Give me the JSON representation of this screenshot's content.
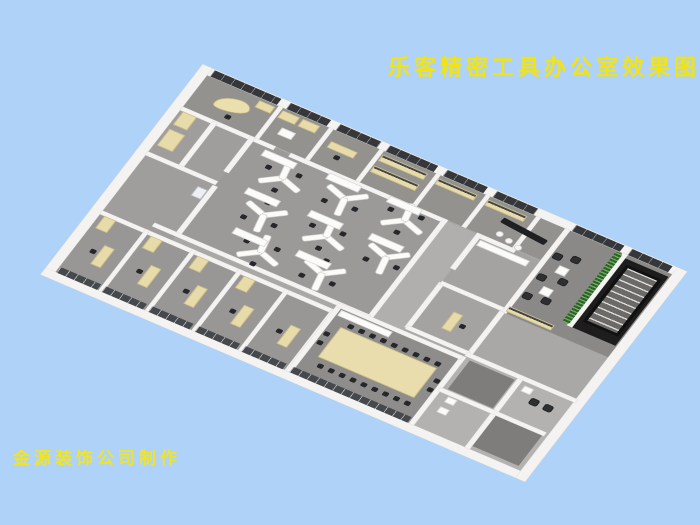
{
  "page": {
    "background": "#aed2f8"
  },
  "title": {
    "text": "乐客精密工具办公室效果图",
    "color": "#f2e318"
  },
  "credit": {
    "text": "金源装饰公司制作",
    "color": "#f0e42a"
  },
  "scene": {
    "description": "axonometric 3D rendering of an office floor plan",
    "wall_color": "#f4f3f1",
    "floor_color": "#a9a7a5",
    "window_color": "#35373b",
    "furniture_cream": "#e7dba9",
    "chair_color": "#26272a",
    "plant_color": "#2e5f30"
  },
  "plan": {
    "width": 600,
    "height": 360,
    "items": [
      {
        "t": "floor",
        "name": "floor-base",
        "x": 0,
        "y": 0,
        "w": 600,
        "h": 360,
        "c": "#aaa8a6"
      },
      {
        "t": "floor",
        "name": "floor-top-rooms",
        "x": 0,
        "y": 0,
        "w": 462,
        "h": 58,
        "c": "#94928e"
      },
      {
        "t": "floor",
        "name": "floor-lounge",
        "x": 462,
        "y": 0,
        "w": 138,
        "h": 152,
        "c": "#8b8987"
      },
      {
        "t": "floor",
        "name": "floor-stairwell",
        "x": 540,
        "y": 6,
        "w": 58,
        "h": 126,
        "c": "#1d1d1d"
      },
      {
        "t": "floor",
        "name": "floor-open-office",
        "x": 90,
        "y": 60,
        "w": 248,
        "h": 176,
        "c": "#9c9a98"
      },
      {
        "t": "floor",
        "name": "floor-corridor",
        "x": 338,
        "y": 60,
        "w": 44,
        "h": 176,
        "c": "#b1afad"
      },
      {
        "t": "floor",
        "name": "floor-mid-rooms",
        "x": 382,
        "y": 60,
        "w": 80,
        "h": 168,
        "c": "#a5a3a1"
      },
      {
        "t": "floor",
        "name": "floor-left-rooms",
        "x": 0,
        "y": 58,
        "w": 90,
        "h": 192,
        "c": "#a09e9c"
      },
      {
        "t": "floor",
        "name": "floor-private-offices",
        "x": 0,
        "y": 250,
        "w": 300,
        "h": 110,
        "c": "#999795"
      },
      {
        "t": "floor",
        "name": "floor-conference",
        "x": 300,
        "y": 236,
        "w": 158,
        "h": 124,
        "c": "#8f8d8b"
      },
      {
        "t": "floor",
        "name": "floor-utility",
        "x": 460,
        "y": 230,
        "w": 140,
        "h": 130,
        "c": "#b4b2b0"
      },
      {
        "t": "floor",
        "name": "floor-utility-room-a",
        "x": 468,
        "y": 238,
        "w": 58,
        "h": 52,
        "c": "#7f7d7b"
      },
      {
        "t": "floor",
        "name": "floor-utility-room-b",
        "x": 534,
        "y": 298,
        "w": 60,
        "h": 56,
        "c": "#7f7d7b"
      },
      {
        "t": "wall",
        "name": "exterior-wall-top",
        "x": -12,
        "y": -12,
        "w": 624,
        "h": 12
      },
      {
        "t": "wall",
        "name": "exterior-wall-left",
        "x": -12,
        "y": -12,
        "w": 12,
        "h": 384
      },
      {
        "t": "wall",
        "name": "exterior-wall-bottom",
        "x": -12,
        "y": 360,
        "w": 624,
        "h": 12
      },
      {
        "t": "wall",
        "name": "exterior-wall-right",
        "x": 600,
        "y": -12,
        "w": 12,
        "h": 384
      },
      {
        "t": "wall",
        "x": 93,
        "y": 0,
        "w": 5,
        "h": 58
      },
      {
        "t": "wall",
        "x": 158,
        "y": 0,
        "w": 5,
        "h": 58
      },
      {
        "t": "wall",
        "x": 223,
        "y": 0,
        "w": 5,
        "h": 58
      },
      {
        "t": "wall",
        "x": 296,
        "y": 0,
        "w": 5,
        "h": 58
      },
      {
        "t": "wall",
        "x": 360,
        "y": 0,
        "w": 5,
        "h": 58
      },
      {
        "t": "wall",
        "x": 425,
        "y": 0,
        "w": 5,
        "h": 58
      },
      {
        "t": "wall",
        "x": 0,
        "y": 58,
        "w": 120,
        "h": 6
      },
      {
        "t": "wall",
        "x": 140,
        "y": 58,
        "w": 198,
        "h": 6
      },
      {
        "t": "wall",
        "x": 382,
        "y": 58,
        "w": 48,
        "h": 6
      },
      {
        "t": "wall",
        "x": 462,
        "y": 0,
        "w": 6,
        "h": 152
      },
      {
        "t": "wall",
        "x": 460,
        "y": 152,
        "w": 6,
        "h": 78
      },
      {
        "t": "wall",
        "x": 536,
        "y": 0,
        "w": 6,
        "h": 132
      },
      {
        "t": "wall",
        "x": 40,
        "y": 60,
        "w": 6,
        "h": 84
      },
      {
        "t": "wall",
        "x": 0,
        "y": 140,
        "w": 90,
        "h": 6
      },
      {
        "t": "wall",
        "x": 88,
        "y": 58,
        "w": 6,
        "h": 64
      },
      {
        "t": "wall",
        "x": 88,
        "y": 148,
        "w": 6,
        "h": 88
      },
      {
        "t": "wall",
        "x": 336,
        "y": 58,
        "w": 6,
        "h": 178
      },
      {
        "t": "wall",
        "x": 380,
        "y": 58,
        "w": 6,
        "h": 64
      },
      {
        "t": "wall",
        "x": 380,
        "y": 148,
        "w": 6,
        "h": 82
      },
      {
        "t": "wall",
        "x": 382,
        "y": 145,
        "w": 80,
        "h": 6
      },
      {
        "t": "wall",
        "x": 60,
        "y": 234,
        "w": 278,
        "h": 6
      },
      {
        "t": "wall",
        "x": 382,
        "y": 226,
        "w": 80,
        "h": 6
      },
      {
        "t": "wall",
        "x": 0,
        "y": 248,
        "w": 300,
        "h": 6
      },
      {
        "t": "wall",
        "x": 56,
        "y": 248,
        "w": 5,
        "h": 112
      },
      {
        "t": "wall",
        "x": 116,
        "y": 248,
        "w": 5,
        "h": 112
      },
      {
        "t": "wall",
        "x": 176,
        "y": 248,
        "w": 5,
        "h": 112
      },
      {
        "t": "wall",
        "x": 236,
        "y": 248,
        "w": 5,
        "h": 112
      },
      {
        "t": "wall",
        "x": 296,
        "y": 248,
        "w": 5,
        "h": 112
      },
      {
        "t": "wall",
        "x": 298,
        "y": 236,
        "w": 6,
        "h": 124
      },
      {
        "t": "wall",
        "x": 456,
        "y": 236,
        "w": 6,
        "h": 124
      },
      {
        "t": "wall",
        "x": 298,
        "y": 236,
        "w": 160,
        "h": 6
      },
      {
        "t": "wall",
        "x": 460,
        "y": 228,
        "w": 142,
        "h": 6
      },
      {
        "t": "wall",
        "x": 528,
        "y": 234,
        "w": 6,
        "h": 58
      },
      {
        "t": "wall",
        "x": 460,
        "y": 292,
        "w": 136,
        "h": 6
      },
      {
        "t": "wall",
        "x": 528,
        "y": 298,
        "w": 6,
        "h": 62
      },
      {
        "t": "window",
        "name": "window-strip",
        "x": 4,
        "y": -11,
        "w": 86,
        "h": 11
      },
      {
        "t": "window",
        "name": "window-strip",
        "x": 102,
        "y": -11,
        "w": 52,
        "h": 11
      },
      {
        "t": "window",
        "name": "window-strip",
        "x": 166,
        "y": -11,
        "w": 53,
        "h": 11
      },
      {
        "t": "window",
        "name": "window-strip",
        "x": 230,
        "y": -11,
        "w": 62,
        "h": 11
      },
      {
        "t": "window",
        "name": "window-strip",
        "x": 304,
        "y": -11,
        "w": 52,
        "h": 11
      },
      {
        "t": "window",
        "name": "window-strip",
        "x": 368,
        "y": -11,
        "w": 53,
        "h": 11
      },
      {
        "t": "window",
        "name": "window-strip",
        "x": 470,
        "y": -11,
        "w": 62,
        "h": 11
      },
      {
        "t": "window",
        "name": "window-strip",
        "x": 542,
        "y": -11,
        "w": 52,
        "h": 11
      },
      {
        "t": "glass",
        "name": "glass-office-front",
        "x": 2,
        "y": 350,
        "w": 52,
        "h": 10
      },
      {
        "t": "glass",
        "name": "glass-office-front",
        "x": 60,
        "y": 350,
        "w": 53,
        "h": 10
      },
      {
        "t": "glass",
        "name": "glass-office-front",
        "x": 120,
        "y": 350,
        "w": 53,
        "h": 10
      },
      {
        "t": "glass",
        "name": "glass-office-front",
        "x": 180,
        "y": 350,
        "w": 53,
        "h": 10
      },
      {
        "t": "glass",
        "name": "glass-office-front",
        "x": 240,
        "y": 350,
        "w": 53,
        "h": 10
      },
      {
        "t": "glass",
        "name": "glass-conference-front",
        "x": 302,
        "y": 350,
        "w": 152,
        "h": 10
      },
      {
        "t": "cdesk",
        "name": "executive-desk",
        "x": 26,
        "y": 16,
        "w": 42,
        "h": 22,
        "rot": -12
      },
      {
        "t": "chair",
        "x": 48,
        "y": 42
      },
      {
        "t": "desk",
        "name": "cabinet",
        "x": 70,
        "y": 4,
        "w": 20,
        "h": 12
      },
      {
        "t": "desk",
        "name": "cabinet",
        "x": 100,
        "y": 4,
        "w": 22,
        "h": 13
      },
      {
        "t": "desk",
        "name": "cabinet",
        "x": 126,
        "y": 4,
        "w": 22,
        "h": 13
      },
      {
        "t": "lowcab",
        "x": 112,
        "y": 28,
        "w": 18,
        "h": 12
      },
      {
        "t": "desk",
        "x": 170,
        "y": 18,
        "w": 34,
        "h": 11
      },
      {
        "t": "chair",
        "x": 184,
        "y": 34
      },
      {
        "t": "shelf",
        "name": "archive-shelf",
        "x": 230,
        "y": 6,
        "w": 58,
        "h": 11
      },
      {
        "t": "shelf",
        "name": "archive-shelf",
        "x": 230,
        "y": 26,
        "w": 58,
        "h": 11
      },
      {
        "t": "shelf",
        "x": 302,
        "y": 6,
        "w": 50,
        "h": 10
      },
      {
        "t": "shelf",
        "x": 366,
        "y": 6,
        "w": 50,
        "h": 10
      },
      {
        "t": "counter",
        "name": "reception-counter",
        "x": 394,
        "y": 24,
        "w": 60,
        "h": 9,
        "rot": 6
      },
      {
        "t": "stool",
        "x": 398,
        "y": 42,
        "d": 9
      },
      {
        "t": "stool",
        "x": 412,
        "y": 46,
        "d": 9
      },
      {
        "t": "stool",
        "x": 426,
        "y": 50,
        "d": 9
      },
      {
        "t": "lowcab",
        "x": 388,
        "y": 66,
        "w": 64,
        "h": 10
      },
      {
        "t": "desk",
        "x": 416,
        "y": 180,
        "w": 12,
        "h": 30
      },
      {
        "t": "chair",
        "x": 432,
        "y": 192
      },
      {
        "t": "desk",
        "name": "cabinet",
        "x": 4,
        "y": 96,
        "w": 20,
        "h": 30
      },
      {
        "t": "desk",
        "name": "cabinet",
        "x": 4,
        "y": 64,
        "w": 18,
        "h": 24
      },
      {
        "t": "machine",
        "name": "copier",
        "x": 74,
        "y": 158,
        "w": 13,
        "h": 17
      },
      {
        "t": "achair",
        "x": 470,
        "y": 38
      },
      {
        "t": "achair",
        "x": 490,
        "y": 32
      },
      {
        "t": "achair",
        "x": 470,
        "y": 76
      },
      {
        "t": "achair",
        "x": 494,
        "y": 70
      },
      {
        "t": "achair",
        "x": 470,
        "y": 110
      },
      {
        "t": "achair",
        "x": 492,
        "y": 106
      },
      {
        "t": "lowcab",
        "name": "coffee-table",
        "x": 484,
        "y": 54,
        "w": 13,
        "h": 13
      },
      {
        "t": "lowcab",
        "name": "coffee-table",
        "x": 484,
        "y": 92,
        "w": 13,
        "h": 13
      },
      {
        "t": "plant",
        "name": "plant-wall",
        "x": 528,
        "y": 2,
        "w": 9,
        "h": 128
      },
      {
        "t": "stairs",
        "name": "staircase",
        "x": 548,
        "y": 14,
        "w": 46,
        "h": 104
      },
      {
        "t": "shelf",
        "x": 466,
        "y": 140,
        "w": 58,
        "h": 9
      },
      {
        "t": "ydesk",
        "x": 148,
        "y": 98,
        "rot": 20
      },
      {
        "t": "ydesk",
        "x": 224,
        "y": 90,
        "rot": 200
      },
      {
        "t": "ydesk",
        "x": 298,
        "y": 84,
        "rot": 20
      },
      {
        "t": "ydesk",
        "x": 158,
        "y": 160,
        "rot": 200
      },
      {
        "t": "ydesk",
        "x": 234,
        "y": 152,
        "rot": 20
      },
      {
        "t": "ydesk",
        "x": 308,
        "y": 146,
        "rot": 200
      },
      {
        "t": "ydesk",
        "x": 182,
        "y": 212,
        "rot": 20
      },
      {
        "t": "ydesk",
        "x": 258,
        "y": 206,
        "rot": 200
      },
      {
        "t": "lowcab",
        "x": 112,
        "y": 68,
        "w": 42,
        "h": 11
      },
      {
        "t": "lowcab",
        "x": 192,
        "y": 62,
        "w": 42,
        "h": 11
      },
      {
        "t": "lowcab",
        "x": 268,
        "y": 58,
        "w": 42,
        "h": 11
      },
      {
        "t": "lowcab",
        "x": 124,
        "y": 130,
        "w": 42,
        "h": 11
      },
      {
        "t": "lowcab",
        "x": 202,
        "y": 124,
        "w": 42,
        "h": 11
      },
      {
        "t": "lowcab",
        "x": 278,
        "y": 120,
        "w": 42,
        "h": 11
      },
      {
        "t": "lowcab",
        "x": 142,
        "y": 192,
        "w": 42,
        "h": 11
      },
      {
        "t": "lowcab",
        "x": 220,
        "y": 186,
        "w": 42,
        "h": 11
      },
      {
        "t": "table",
        "name": "conference-table",
        "x": 318,
        "y": 268,
        "w": 124,
        "h": 54,
        "c": "#e9ddae"
      },
      {
        "t": "lowcab",
        "x": 306,
        "y": 244,
        "w": 66,
        "h": 10
      },
      {
        "t": "crow",
        "name": "conference-chairs-top",
        "x": 324,
        "y": 258,
        "n": 9,
        "dx": 14,
        "dy": 0
      },
      {
        "t": "crow",
        "name": "conference-chairs-bottom",
        "x": 324,
        "y": 330,
        "n": 9,
        "dx": 14,
        "dy": 0
      },
      {
        "t": "crow",
        "name": "conference-chairs-left",
        "x": 306,
        "y": 282,
        "n": 2,
        "dx": 0,
        "dy": 16
      },
      {
        "t": "crow",
        "name": "conference-chairs-right",
        "x": 448,
        "y": 282,
        "n": 2,
        "dx": 0,
        "dy": 16
      },
      {
        "t": "desk",
        "x": 28,
        "y": 294,
        "w": 13,
        "h": 34
      },
      {
        "t": "desk",
        "x": 88,
        "y": 294,
        "w": 13,
        "h": 34
      },
      {
        "t": "desk",
        "x": 148,
        "y": 294,
        "w": 13,
        "h": 34
      },
      {
        "t": "desk",
        "x": 208,
        "y": 294,
        "w": 13,
        "h": 34
      },
      {
        "t": "desk",
        "x": 268,
        "y": 294,
        "w": 13,
        "h": 34
      },
      {
        "t": "chair",
        "x": 18,
        "y": 306
      },
      {
        "t": "chair",
        "x": 78,
        "y": 306
      },
      {
        "t": "chair",
        "x": 138,
        "y": 306
      },
      {
        "t": "chair",
        "x": 198,
        "y": 306
      },
      {
        "t": "chair",
        "x": 258,
        "y": 306
      },
      {
        "t": "desk",
        "name": "cabinet",
        "x": 6,
        "y": 254,
        "w": 15,
        "h": 22
      },
      {
        "t": "desk",
        "name": "cabinet",
        "x": 66,
        "y": 254,
        "w": 15,
        "h": 22
      },
      {
        "t": "desk",
        "name": "cabinet",
        "x": 126,
        "y": 254,
        "w": 15,
        "h": 22
      },
      {
        "t": "desk",
        "name": "cabinet",
        "x": 186,
        "y": 254,
        "w": 15,
        "h": 22
      },
      {
        "t": "lowcab",
        "name": "fixture",
        "x": 474,
        "y": 300,
        "w": 12,
        "h": 10
      },
      {
        "t": "lowcab",
        "name": "fixture",
        "x": 474,
        "y": 318,
        "w": 12,
        "h": 10
      },
      {
        "t": "achair",
        "x": 556,
        "y": 252
      },
      {
        "t": "achair",
        "x": 574,
        "y": 252
      },
      {
        "t": "lowcab",
        "name": "fixture",
        "x": 540,
        "y": 240,
        "w": 12,
        "h": 10
      }
    ]
  }
}
